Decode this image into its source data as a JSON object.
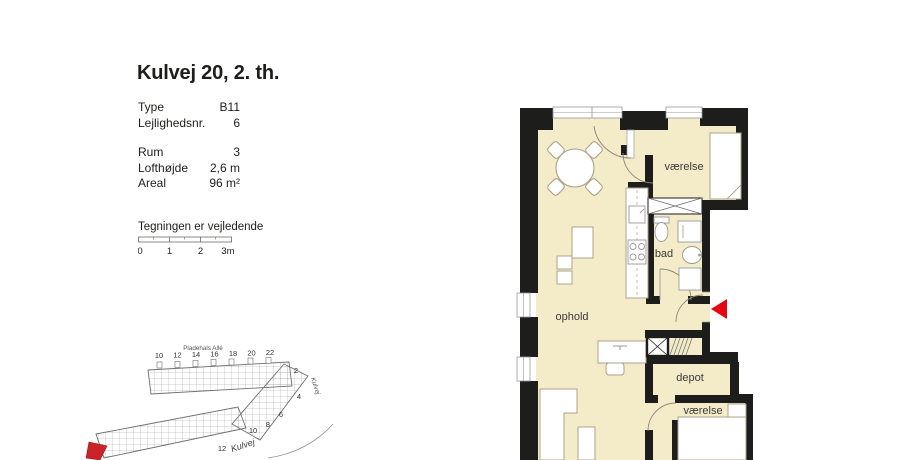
{
  "page": {
    "title": "Kulvej 20, 2. th.",
    "disclaimer": "Tegningen er vejledende"
  },
  "details": {
    "rows": [
      {
        "label": "Type",
        "value": "B11"
      },
      {
        "label": "Lejlighedsnr.",
        "value": "6"
      },
      {
        "label": "Rum",
        "value": "3"
      },
      {
        "label": "Lofthøjde",
        "value": "2,6 m"
      },
      {
        "label": "Areal",
        "value": "96 m²"
      }
    ]
  },
  "scalebar": {
    "tick0": "0",
    "tick1": "1",
    "tick2": "2",
    "tick3": "3m"
  },
  "floorplan": {
    "rooms": {
      "bedroom1": "værelse",
      "bath": "bad",
      "living": "ophold",
      "storage": "depot",
      "bedroom2": "værelse"
    },
    "colors": {
      "floor": "#f4ecc9",
      "wall": "#1d1d1b",
      "entry_arrow": "#e30613",
      "furniture_stroke": "#aba388"
    }
  },
  "siteplan": {
    "street_top": "Pladehals Allé",
    "street_right": "Kulvej",
    "street_bottom": "Kulvej",
    "numbers_top": [
      "10",
      "12",
      "14",
      "16",
      "18",
      "20",
      "22"
    ],
    "numbers_side": [
      "2",
      "4",
      "6",
      "8",
      "10",
      "12"
    ],
    "marker_color": "#cc2229"
  }
}
